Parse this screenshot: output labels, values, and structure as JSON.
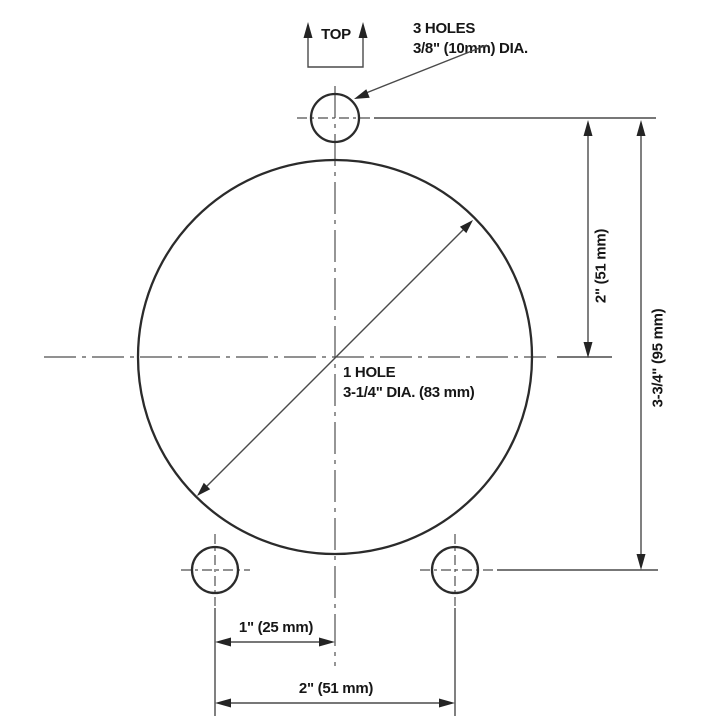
{
  "drawing": {
    "top_marker": {
      "label": "TOP"
    },
    "holes_callout": {
      "line1": "3 HOLES",
      "line2": "3/8\" (10mm) DIA."
    },
    "center_callout": {
      "line1": "1 HOLE",
      "line2": "3-1/4\" DIA. (83 mm)"
    },
    "dims": {
      "vertical_inner": "2\" (51 mm)",
      "vertical_outer": "3-3/4\" (95 mm)",
      "horizontal_inner": "1\" (25 mm)",
      "horizontal_outer": "2\" (51 mm)"
    },
    "colors": {
      "object_line": "#2b2b2b",
      "thin_line": "#4a4a4a",
      "text": "#161616",
      "background": "#ffffff"
    }
  }
}
